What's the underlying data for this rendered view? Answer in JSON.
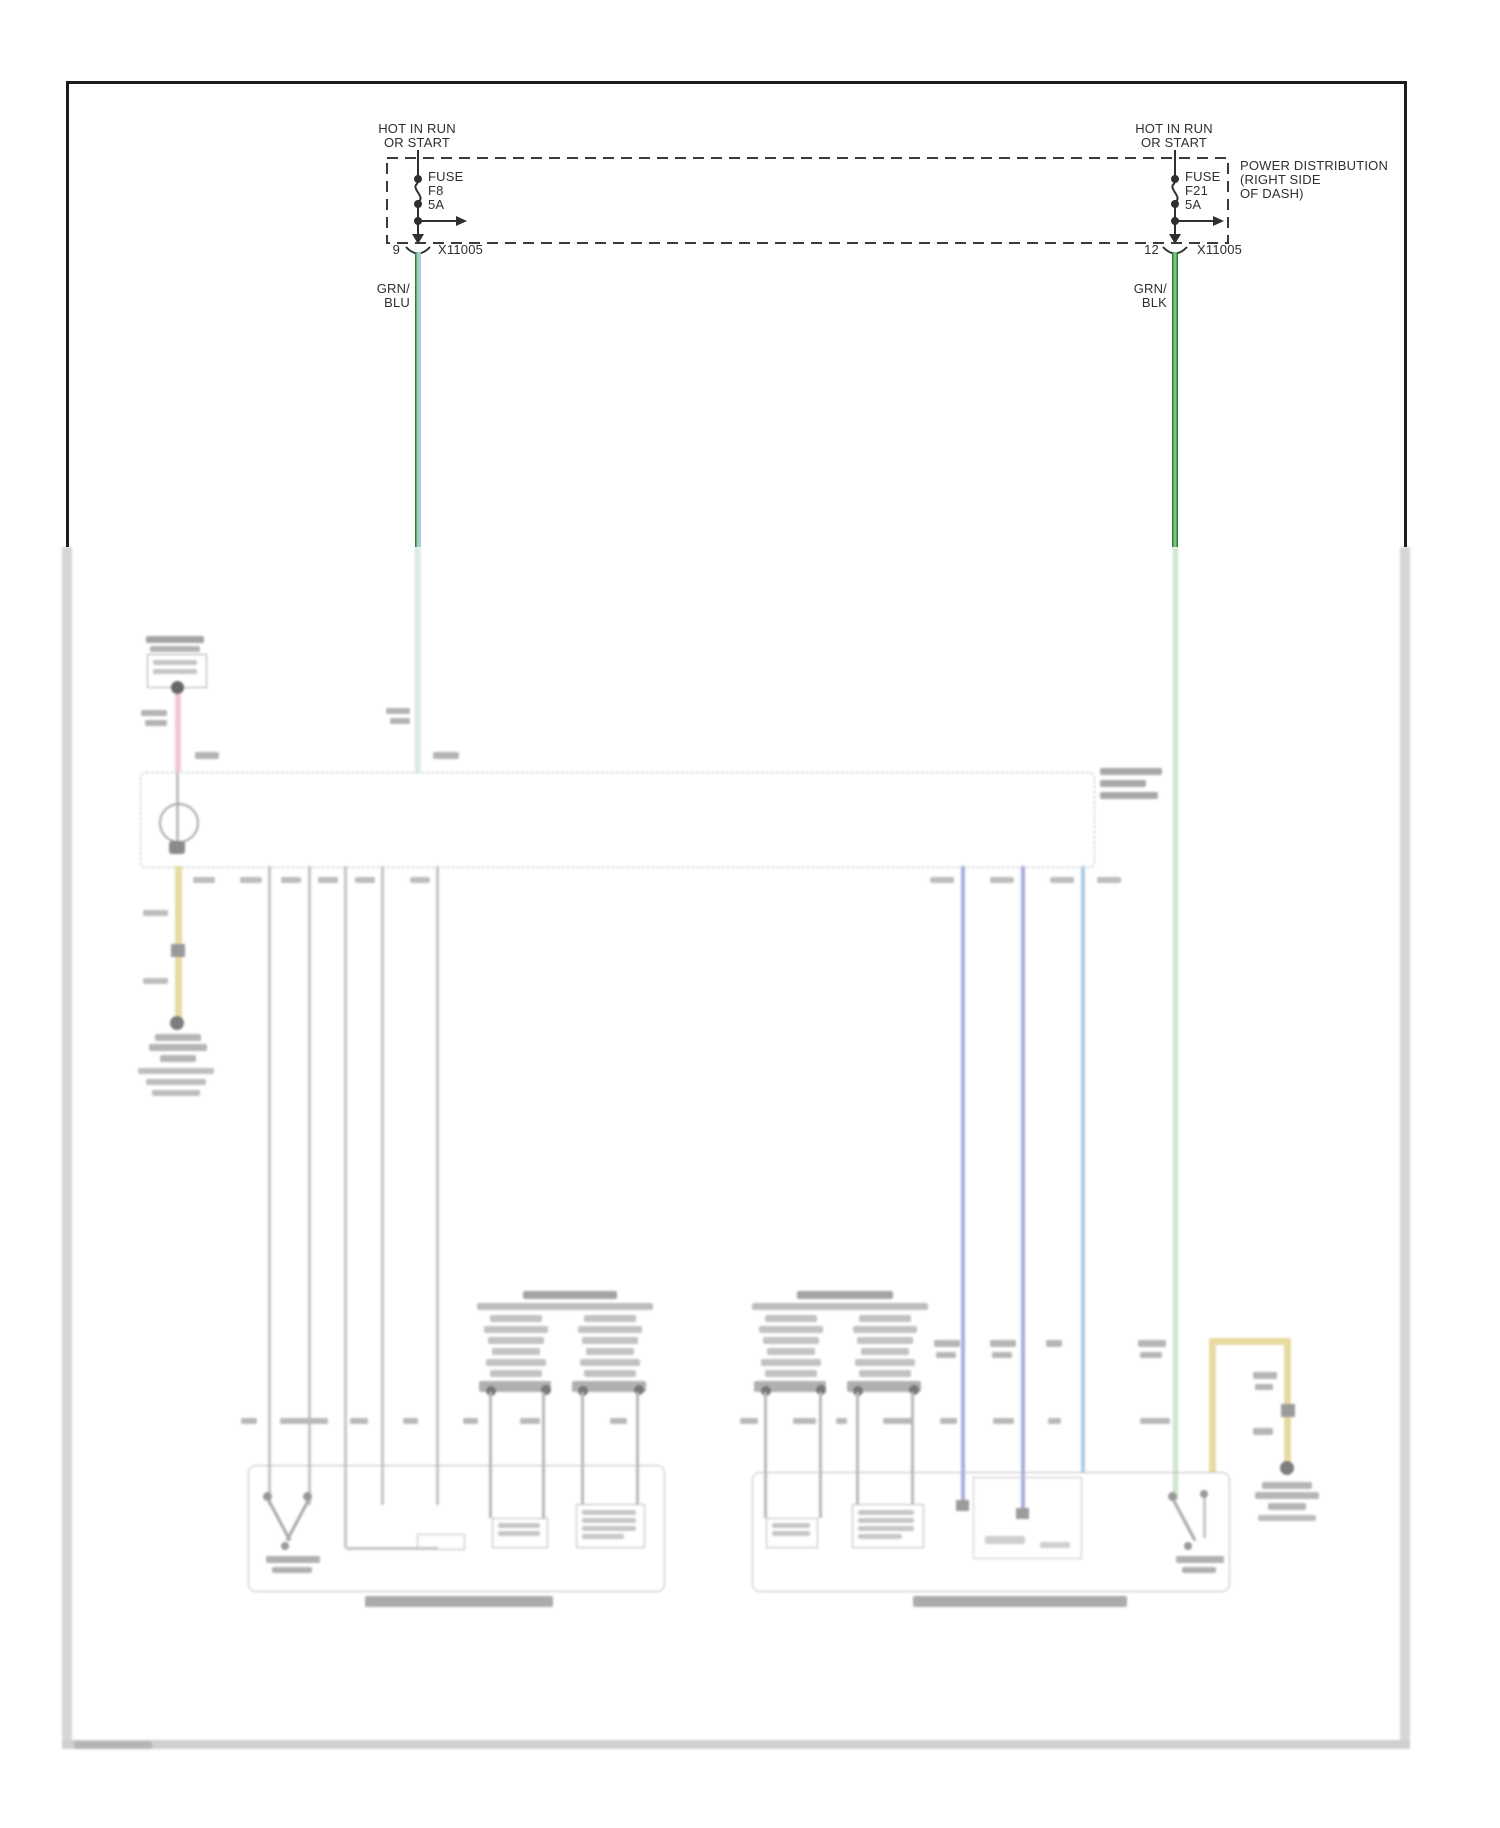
{
  "power_distribution": {
    "box_label_lines": [
      "POWER DISTRIBUTION",
      "(RIGHT SIDE",
      "OF DASH)"
    ],
    "left": {
      "hot_line1": "HOT IN RUN",
      "hot_line2": "OR START",
      "fuse_label": "FUSE",
      "fuse_id": "F8",
      "fuse_rating": "5A",
      "pin": "9",
      "connector": "X11005",
      "wire_color_line1": "GRN/",
      "wire_color_line2": "BLU"
    },
    "right": {
      "hot_line1": "HOT IN RUN",
      "hot_line2": "OR START",
      "fuse_label": "FUSE",
      "fuse_id": "F21",
      "fuse_rating": "5A",
      "pin": "12",
      "connector": "X11005",
      "wire_color_line1": "GRN/",
      "wire_color_line2": "BLK"
    }
  },
  "colors": {
    "line": "#2f2f2f",
    "green_dark": "#2f7d3a",
    "green_light": "#9fd3a7",
    "blue_tracer": "#a9c7e8",
    "green_mid": "#7cc57c"
  }
}
